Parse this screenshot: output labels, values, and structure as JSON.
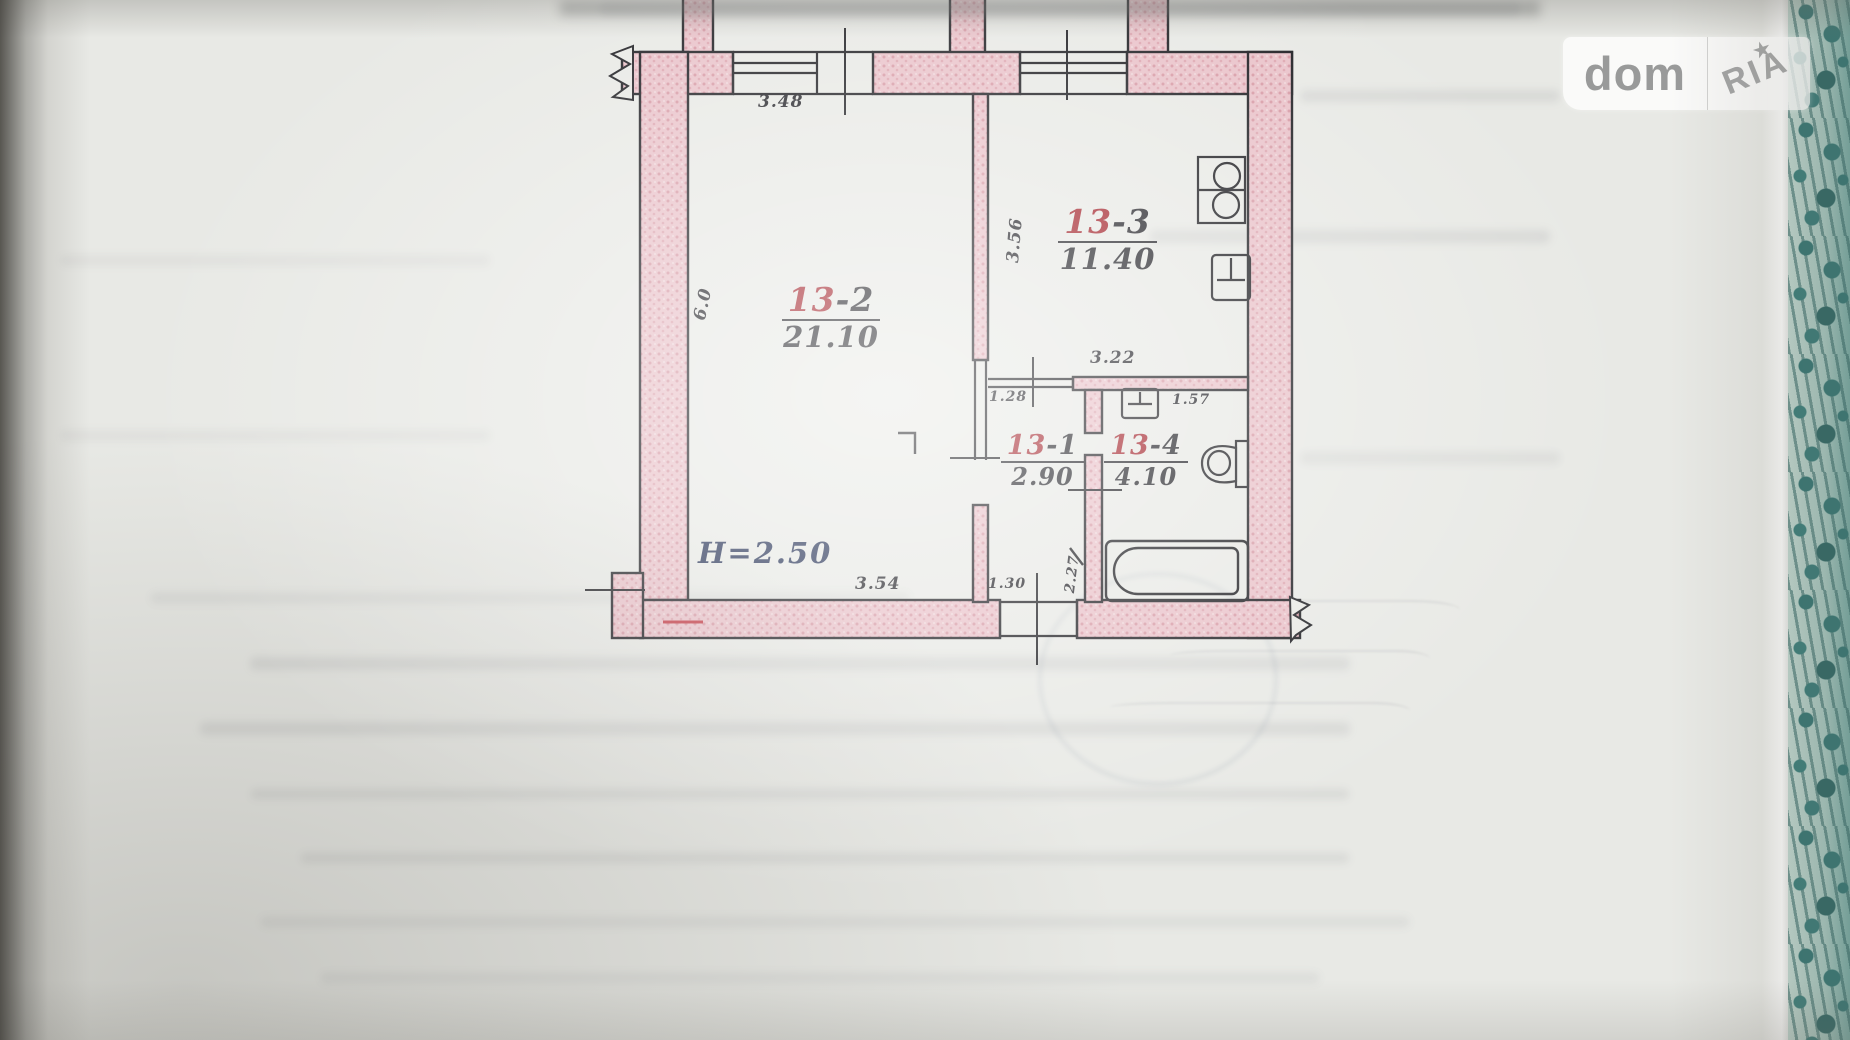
{
  "watermark": {
    "brand_left": "dom",
    "brand_right": "RIA",
    "star": "★"
  },
  "floor_plan": {
    "rooms": [
      {
        "id": "13-2",
        "prefix": "13",
        "suffix": "-2",
        "area": "21.10"
      },
      {
        "id": "13-3",
        "prefix": "13",
        "suffix": "-3",
        "area": "11.40"
      },
      {
        "id": "13-1",
        "prefix": "13",
        "suffix": "-1",
        "area": "2.90"
      },
      {
        "id": "13-4",
        "prefix": "13",
        "suffix": "-4",
        "area": "4.10"
      }
    ],
    "height_note": "H=2.50",
    "dimensions": {
      "window_top": "3.48",
      "kitchen_side": "3.56",
      "kitchen_bottom": "3.22",
      "hall_top": "1.28",
      "bath_top": "1.57",
      "living_bottom": "3.54",
      "entry_door": "1.30",
      "hall_side": "2.27",
      "living_side": "6.0"
    },
    "colors": {
      "wall_fill": "#e9c2c9",
      "ink": "#25252a",
      "room_number_red": "#a3242c",
      "height_ink": "#273356",
      "fabric_teal": "#2b6f6c"
    }
  }
}
